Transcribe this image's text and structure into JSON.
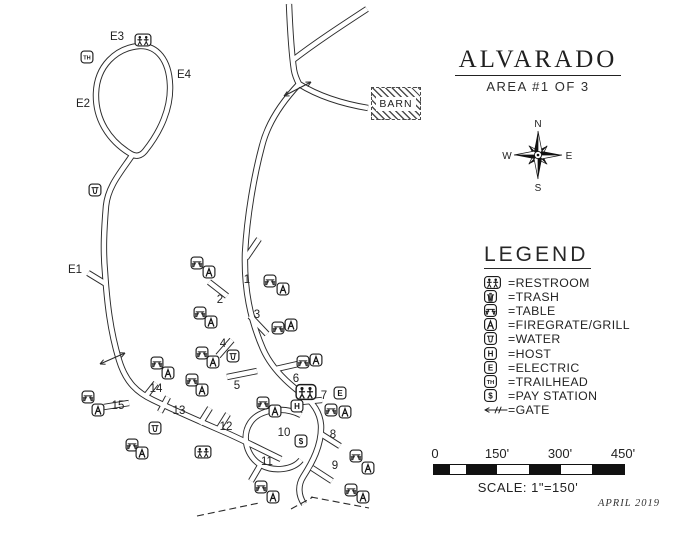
{
  "title": {
    "name": "ALVARADO",
    "subtitle": "AREA #1 OF 3"
  },
  "compass": {
    "n": "N",
    "e": "E",
    "s": "S",
    "w": "W"
  },
  "barn": {
    "label": "BARN"
  },
  "legend": {
    "title": "LEGEND",
    "items": [
      {
        "symbol": "restroom",
        "label": "=RESTROOM"
      },
      {
        "symbol": "trash",
        "label": "=TRASH"
      },
      {
        "symbol": "table",
        "label": "=TABLE"
      },
      {
        "symbol": "firegrate",
        "label": "=FIREGRATE/GRILL"
      },
      {
        "symbol": "water",
        "label": "=WATER"
      },
      {
        "symbol": "host",
        "label": "=HOST"
      },
      {
        "symbol": "electric",
        "label": "=ELECTRIC"
      },
      {
        "symbol": "trailhead",
        "label": "=TRAILHEAD"
      },
      {
        "symbol": "pay",
        "label": "=PAY STATION"
      },
      {
        "symbol": "gate",
        "label": "=GATE"
      }
    ]
  },
  "scalebar": {
    "tick_labels": [
      "0",
      "150'",
      "300'",
      "450'"
    ],
    "scale_text": "SCALE:  1\"=150'",
    "date": "APRIL 2019"
  },
  "colors": {
    "ink": "#2b2b2b",
    "paper": "#ffffff"
  },
  "map": {
    "site_labels": [
      {
        "text": "E3",
        "x": 117,
        "y": 40
      },
      {
        "text": "E4",
        "x": 184,
        "y": 78
      },
      {
        "text": "E2",
        "x": 83,
        "y": 107
      },
      {
        "text": "E1",
        "x": 75,
        "y": 273
      },
      {
        "text": "1",
        "x": 247,
        "y": 283
      },
      {
        "text": "2",
        "x": 220,
        "y": 303
      },
      {
        "text": "3",
        "x": 257,
        "y": 318
      },
      {
        "text": "4",
        "x": 223,
        "y": 347
      },
      {
        "text": "5",
        "x": 237,
        "y": 389
      },
      {
        "text": "6",
        "x": 296,
        "y": 382
      },
      {
        "text": "7",
        "x": 324,
        "y": 399
      },
      {
        "text": "8",
        "x": 333,
        "y": 438
      },
      {
        "text": "9",
        "x": 335,
        "y": 469
      },
      {
        "text": "10",
        "x": 284,
        "y": 436
      },
      {
        "text": "11",
        "x": 267,
        "y": 465
      },
      {
        "text": "12",
        "x": 226,
        "y": 430
      },
      {
        "text": "13",
        "x": 179,
        "y": 414
      },
      {
        "text": "14",
        "x": 156,
        "y": 392
      },
      {
        "text": "15",
        "x": 118,
        "y": 409
      }
    ],
    "icons": [
      {
        "type": "restroom",
        "x": 143,
        "y": 40
      },
      {
        "type": "restroom",
        "x": 306,
        "y": 392,
        "s": 1.25
      },
      {
        "type": "restroom",
        "x": 203,
        "y": 452
      },
      {
        "type": "trailhead",
        "x": 87,
        "y": 57
      },
      {
        "type": "water",
        "x": 95,
        "y": 190
      },
      {
        "type": "water",
        "x": 233,
        "y": 356
      },
      {
        "type": "water",
        "x": 155,
        "y": 428
      },
      {
        "type": "electric",
        "x": 340,
        "y": 393
      },
      {
        "type": "host",
        "x": 297,
        "y": 406
      },
      {
        "type": "pay",
        "x": 301,
        "y": 441
      },
      {
        "type": "table",
        "x": 197,
        "y": 263
      },
      {
        "type": "firegrate",
        "x": 209,
        "y": 272
      },
      {
        "type": "table",
        "x": 270,
        "y": 281
      },
      {
        "type": "firegrate",
        "x": 283,
        "y": 289
      },
      {
        "type": "table",
        "x": 200,
        "y": 313
      },
      {
        "type": "firegrate",
        "x": 211,
        "y": 322
      },
      {
        "type": "table",
        "x": 278,
        "y": 328
      },
      {
        "type": "firegrate",
        "x": 291,
        "y": 325
      },
      {
        "type": "table",
        "x": 202,
        "y": 353
      },
      {
        "type": "firegrate",
        "x": 213,
        "y": 362
      },
      {
        "type": "table",
        "x": 303,
        "y": 362
      },
      {
        "type": "firegrate",
        "x": 316,
        "y": 360
      },
      {
        "type": "table",
        "x": 331,
        "y": 410
      },
      {
        "type": "firegrate",
        "x": 345,
        "y": 412
      },
      {
        "type": "table",
        "x": 263,
        "y": 403
      },
      {
        "type": "firegrate",
        "x": 275,
        "y": 411
      },
      {
        "type": "table",
        "x": 356,
        "y": 456
      },
      {
        "type": "firegrate",
        "x": 368,
        "y": 468
      },
      {
        "type": "table",
        "x": 351,
        "y": 490
      },
      {
        "type": "firegrate",
        "x": 363,
        "y": 497
      },
      {
        "type": "table",
        "x": 261,
        "y": 487
      },
      {
        "type": "firegrate",
        "x": 273,
        "y": 497
      },
      {
        "type": "table",
        "x": 132,
        "y": 445
      },
      {
        "type": "firegrate",
        "x": 142,
        "y": 453
      },
      {
        "type": "table",
        "x": 88,
        "y": 397
      },
      {
        "type": "firegrate",
        "x": 98,
        "y": 410
      },
      {
        "type": "table",
        "x": 157,
        "y": 363
      },
      {
        "type": "firegrate",
        "x": 168,
        "y": 373
      },
      {
        "type": "table",
        "x": 192,
        "y": 380
      },
      {
        "type": "firegrate",
        "x": 202,
        "y": 390
      }
    ],
    "roads": [
      "M 139,46 C 116,48 97,66 96,93 C 95,119 109,141 131,154 C 136,157 141,156 145,151 C 161,131 171,108 170,85 C 169,60 157,45 139,46 Z",
      "M 133,154 C 121,172 108,186 106,206 C 104,230 103,250 105,272 C 107,302 110,330 119,360 C 126,383 138,393 153,400 C 180,413 206,424 229,434 C 251,444 266,452 281,459",
      "M 289,4 C 290,28 291,50 294,70 C 295,76 297,80 299,84",
      "M 293,60 C 315,43 341,26 367,9",
      "M 299,84 C 320,97 344,104 368,108",
      "M 299,84 C 283,101 268,122 262,146 C 254,176 247,216 245,253 C 244,289 250,319 263,349 C 271,367 285,381 301,393 C 313,402 320,413 321,425 C 322,445 312,463 303,477 C 298,485 298,495 304,504",
      "M 301,415 C 284,406 259,409 250,423 C 241,437 247,457 261,465 C 274,472 293,470 301,460"
    ],
    "spurs": [
      "M 106,284 L 88,273",
      "M 246,258 L 259,239",
      "M 227,296 L 209,282",
      "M 250,316 L 267,334",
      "M 232,340 L 218,356",
      "M 257,371 L 227,377",
      "M 276,369 L 298,364",
      "M 301,402 L 322,400",
      "M 321,434 L 340,446",
      "M 312,468 L 332,481",
      "M 261,464 L 251,481",
      "M 218,430 L 228,414",
      "M 200,424 L 210,408",
      "M 160,412 L 168,397",
      "M 145,397 L 156,383",
      "M 129,403 L 104,407"
    ],
    "gates": [
      {
        "x1": 284,
        "y1": 96,
        "x2": 311,
        "y2": 82
      },
      {
        "x1": 100,
        "y1": 364,
        "x2": 125,
        "y2": 353
      }
    ],
    "dashed": [
      "M 197,516 L 259,503",
      "M 311,497 L 369,508",
      "M 291,509 L 313,497"
    ]
  }
}
